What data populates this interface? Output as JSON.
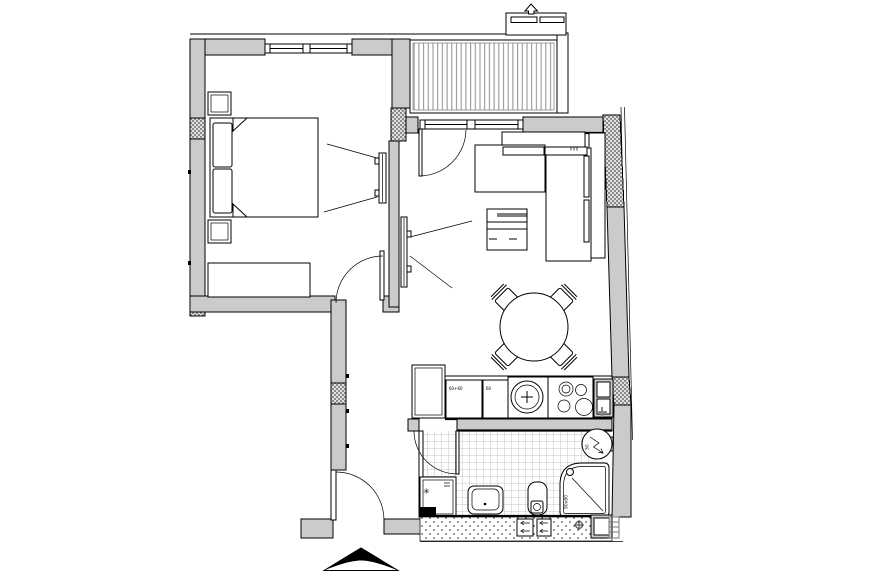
{
  "document": {
    "kind": "apartment floor plan drawing",
    "annotations": {
      "shower_size": "90x90",
      "boiler_size": "50",
      "kitchen_cabinet_a": "60+60",
      "kitchen_cabinet_b": "60",
      "washer_symbol": "✳"
    },
    "colors": {
      "wall_fill": "#cbcbcb",
      "line": "#000000",
      "tile_line": "#b5b5b5",
      "balcony_stripe": "#8f8f8f",
      "column_hatch": "#8a8a8a"
    },
    "icons": {
      "ac_vent": "up-arrow",
      "entrance_marker": "wide chevron triangle",
      "boiler": "lightning-arrow in circle",
      "gas_point": "gray cross",
      "duct_vents": "left-arrows in boxes"
    }
  }
}
